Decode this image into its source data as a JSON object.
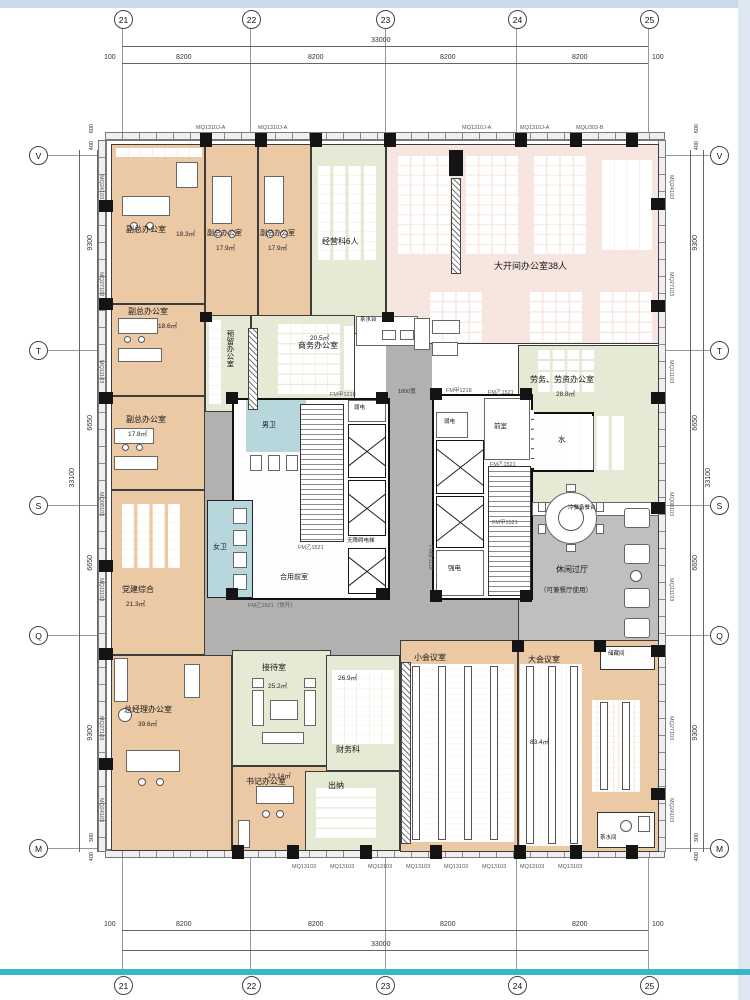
{
  "grid": {
    "cols": [
      "21",
      "22",
      "23",
      "24",
      "25"
    ],
    "rows": [
      "V",
      "T",
      "S",
      "Q",
      "M"
    ],
    "col_span": "8200",
    "col_total": "33000",
    "edge": "100",
    "row_spans": [
      "9300",
      "6650",
      "6650",
      "9300"
    ],
    "row_total": "33100",
    "top_small": [
      "600",
      "400"
    ],
    "bottom_small": [
      "300",
      "400"
    ]
  },
  "walls": {
    "left": [
      "MQ24103",
      "MQ27103",
      "MQ11103",
      "MQ08103",
      "MQ11103",
      "MQ27103",
      "MQ24103"
    ],
    "right": [
      "MQ24103",
      "MQ27103",
      "MQ11103",
      "MQ08103",
      "MQ11103",
      "MQ27103",
      "MQ24103"
    ],
    "top_label": "MQ1310J-A",
    "top_label_b": "MQU303-B",
    "bottom_label": "MQ13103"
  },
  "rooms": {
    "vice1": {
      "name": "副总办公室",
      "area": "18.3㎡"
    },
    "vice2": {
      "name": "副总办公室",
      "area": "17.9㎡"
    },
    "vice3": {
      "name": "副总办公室",
      "area": "17.9㎡"
    },
    "mgmt": {
      "name": "经营科6人"
    },
    "open": {
      "name": "大开间办公室38人"
    },
    "vice4": {
      "name": "副总办公室",
      "area": "18.6㎡"
    },
    "vice5": {
      "name": "副总办公室",
      "area": "17.8㎡"
    },
    "reserved": {
      "name": "预留办公室"
    },
    "business": {
      "name": "商务办公室",
      "area": "20.5㎡"
    },
    "labor": {
      "name": "劳务、劳资办公室",
      "area": "28.8㎡"
    },
    "party": {
      "name": "党建综合",
      "area": "21.3㎡"
    },
    "leisure": {
      "name": "休闲过厅",
      "note": "（可兼餐厅使用）"
    },
    "gm": {
      "name": "总经理办公室",
      "area": "39.6㎡"
    },
    "reception": {
      "name": "接待室",
      "area": "25.2㎡"
    },
    "secretary": {
      "name": "书记办公室",
      "area": "23.14㎡"
    },
    "finance": {
      "name": "财务科",
      "area": "26.9㎡"
    },
    "cashier": {
      "name": "出纳"
    },
    "small_conf": {
      "name": "小会议室"
    },
    "large_conf": {
      "name": "大会议室",
      "area": "83.4㎡"
    },
    "storage": {
      "name": "储藏间"
    },
    "pantry": {
      "name": "茶水间"
    }
  },
  "core": {
    "men_wc": "男卫",
    "women_wc": "女卫",
    "front_room": "前室",
    "shared_front": "合用前室",
    "weak": "弱电",
    "strong": "强电",
    "accessible_lift": "无障碍电梯",
    "water": "水",
    "buffet": "冷餐备餐台",
    "tea": "茶水台",
    "width_note": "1800宽"
  },
  "doors": {
    "a1218": "FM甲1218",
    "b1521": "FM乙1521",
    "b1521_open": "FM乙1521（常开）",
    "a1118": "FM甲1118",
    "a1521": "FM甲1521"
  }
}
